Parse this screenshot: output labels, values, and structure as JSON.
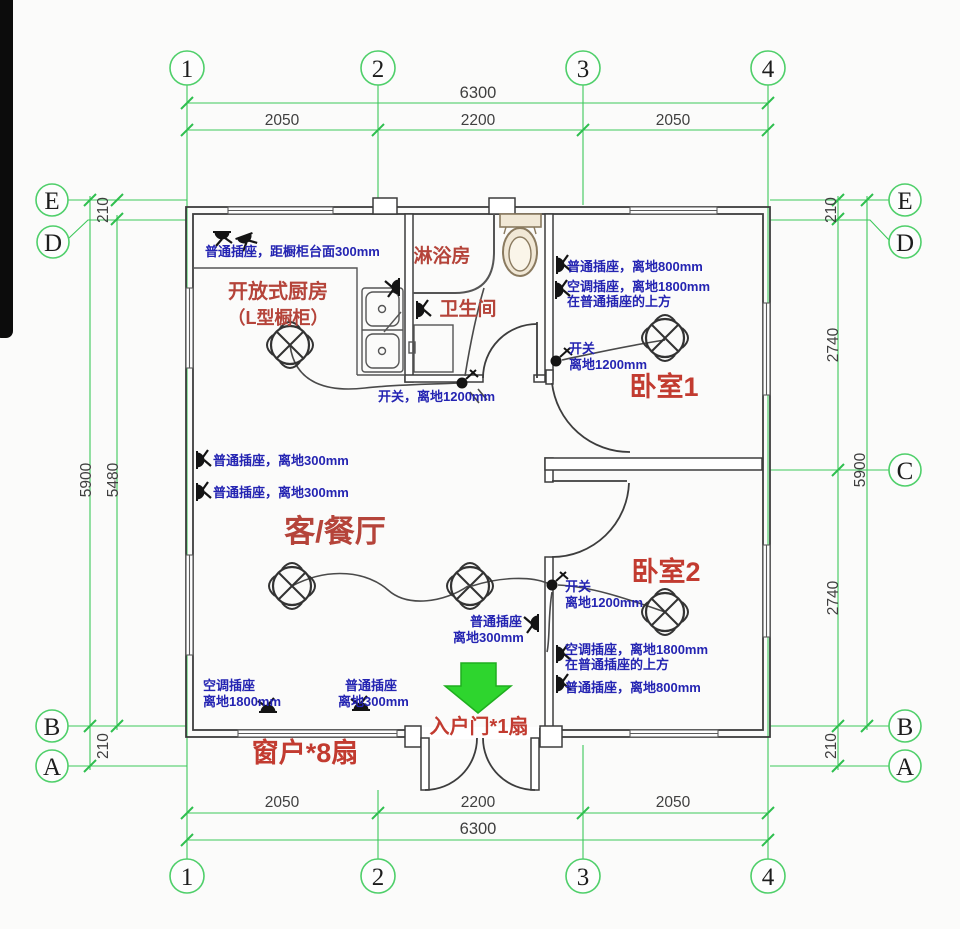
{
  "grid_bubbles": {
    "top": [
      "1",
      "2",
      "3",
      "4"
    ],
    "bottom": [
      "1",
      "2",
      "3",
      "4"
    ],
    "left": [
      "E",
      "D",
      "B",
      "A"
    ],
    "right": [
      "E",
      "D",
      "C",
      "B",
      "A"
    ]
  },
  "dims": {
    "top_total": "6300",
    "top_s1": "2050",
    "top_s2": "2200",
    "top_s3": "2050",
    "bot_s1": "2050",
    "bot_s2": "2200",
    "bot_s3": "2050",
    "bot_total": "6300",
    "left_total": "5900",
    "left_inner": "5480",
    "left_210_top": "210",
    "left_210_bot": "210",
    "right_total": "5900",
    "right_210_top": "210",
    "right_2740_a": "2740",
    "right_2740_b": "2740",
    "right_210_bot": "210"
  },
  "rooms": {
    "shower": "淋浴房",
    "wc": "卫生间",
    "kitchen1": "开放式厨房",
    "kitchen2": "（L型橱柜）",
    "bed1": "卧室1",
    "bed2": "卧室2",
    "living": "客/餐厅",
    "windows_note": "窗户*8扇",
    "entry_note": "入户门*1扇"
  },
  "elec": {
    "kitchen_socket": "普通插座，距橱柜台面300mm",
    "bed1_socket": "普通插座，离地800mm",
    "bed1_ac1": "空调插座，离地1800mm",
    "bed1_ac2": "在普通插座的上方",
    "bed1_sw1": "开关",
    "bed1_sw2": "离地1200mm",
    "bath_switch": "开关，离地1200mm",
    "living_socket1": "普通插座，离地300mm",
    "living_socket2": "普通插座，离地300mm",
    "bed2_sw1": "开关",
    "bed2_sw2": "离地1200mm",
    "hall_socket1": "普通插座",
    "hall_socket2": "离地300mm",
    "bed2_ac1": "空调插座，离地1800mm",
    "bed2_ac2": "在普通插座的上方",
    "bed2_socket": "普通插座，离地800mm",
    "bl_ac1": "空调插座",
    "bl_ac2": "离地1800mm",
    "bl_s1": "普通插座",
    "bl_s2": "离地300mm"
  },
  "colors": {
    "grid_green": "#3cc85a",
    "arrow_green": "#2ed52e",
    "label_red": "#b5443a",
    "note_blue": "#2424b2",
    "wall": "#3d3d3d"
  }
}
